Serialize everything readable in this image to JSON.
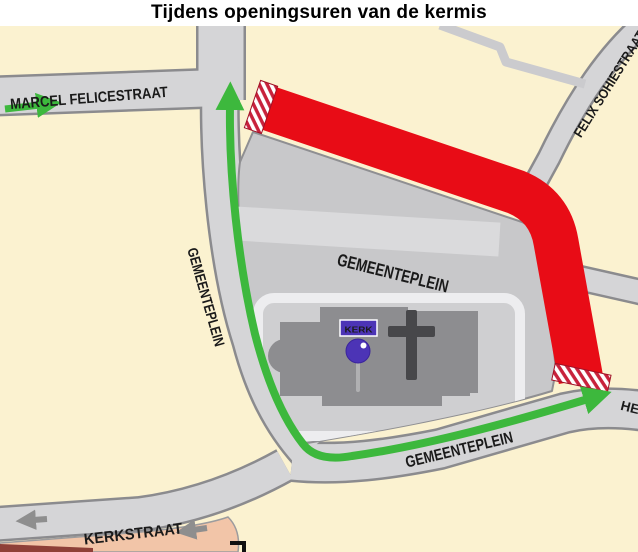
{
  "title": "Tijdens openingsuren van de kermis",
  "map": {
    "labels": {
      "marcel_felicestraat": "MARCEL FELICESTRAAT",
      "felix_sohiestraat": "FELIX SOHIESTRAAT",
      "gemeenteplein_plaza": "GEMEENTEPLEIN",
      "gemeenteplein_west": "GEMEENTEPLEIN",
      "gemeenteplein_south": "GEMEENTEPLEIN",
      "kerkstraat": "KERKSTRAAT",
      "street_name_partial_right": "HE",
      "kerk": "KERK"
    },
    "colors": {
      "map_background": "#FBF2D0",
      "street_fill": "#D5D5D7",
      "street_casing": "#8B8B8E",
      "plaza_fill": "#C8C8CA",
      "plaza_strip": "#DADADC",
      "ring_road_white": "#EDEDEF",
      "church_pad": "#CFCFD1",
      "building_gray": "#8D8D90",
      "cross_gray": "#47474A",
      "closed_route_red": "#E80C16",
      "barrier_stripe_red": "#C8223C",
      "detour_green": "#3DB83D",
      "one_way_arrow_gray": "#8E8E8E",
      "salmon_block": "#F2C5A8",
      "maroon_block": "#8E4038",
      "kerk_badge_purple": "#4C34B6"
    }
  }
}
